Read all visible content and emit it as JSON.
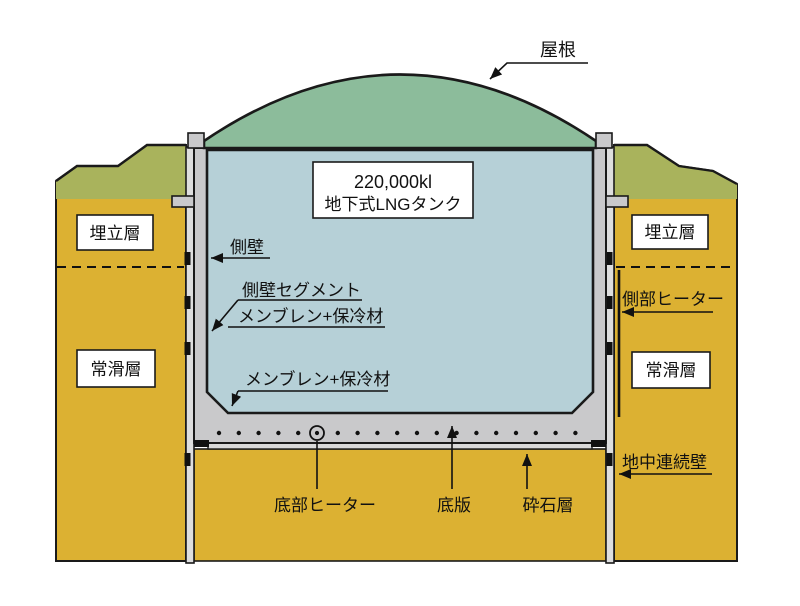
{
  "diagram": {
    "tank_label": {
      "line1": "220,000kl",
      "line2": "地下式LNGタンク"
    },
    "soil_labels": {
      "landfill_left": "埋立層",
      "landfill_right": "埋立層",
      "tokoname_left": "常滑層",
      "tokoname_right": "常滑層"
    },
    "annotations": {
      "roof": "屋根",
      "side_wall": "側壁",
      "side_wall_segment": "側壁セグメント",
      "membrane_insulation_upper": "メンブレン+保冷材",
      "membrane_insulation_lower": "メンブレン+保冷材",
      "side_heater": "側部ヒーター",
      "underground_diaphragm_wall": "地中連続壁",
      "bottom_heater": "底部ヒーター",
      "bottom_slab": "底版",
      "crushed_stone_layer": "砕石層"
    },
    "colors": {
      "roof_green": "#8cbc9b",
      "lng_blue": "#b6d0d7",
      "soil_ochre": "#dcb132",
      "topsoil_olive": "#a9b35c",
      "concrete_gray": "#c9c9cb",
      "diaphragm_gray": "#dedede",
      "crushed_stone_gray": "#d9d9d9",
      "outline": "#1a1a1a"
    }
  }
}
